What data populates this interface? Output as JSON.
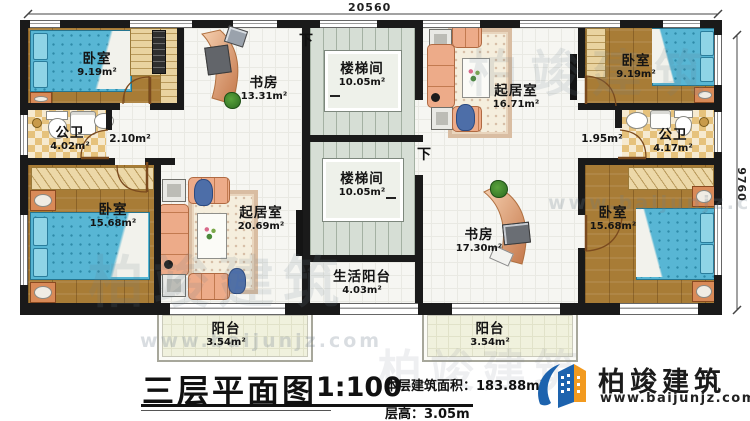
{
  "plan": {
    "title": "三层平面图",
    "scale": "1:100",
    "area_label": "本层建筑面积：",
    "area_value": "183.88m²",
    "floor_height_label": "层高：",
    "floor_height_value": "3.05m"
  },
  "dimensions": {
    "top": "20560",
    "right": "9760"
  },
  "labels": {
    "down": "下"
  },
  "rooms": {
    "bedroom_tl": {
      "name": "卧室",
      "area": "9.19m²"
    },
    "study_top": {
      "name": "书房",
      "area": "13.31m²"
    },
    "stair_top": {
      "name": "楼梯间",
      "area": "10.05m²"
    },
    "living_top": {
      "name": "起居室",
      "area": "16.71m²"
    },
    "bedroom_tr": {
      "name": "卧室",
      "area": "9.19m²"
    },
    "bath_left": {
      "name": "公卫",
      "area": "4.02m²"
    },
    "hall_left": {
      "area": "2.10m²"
    },
    "hall_right": {
      "area": "1.95m²"
    },
    "bath_right": {
      "name": "公卫",
      "area": "4.17m²"
    },
    "bedroom_bl": {
      "name": "卧室",
      "area": "15.68m²"
    },
    "living_bottom": {
      "name": "起居室",
      "area": "20.69m²"
    },
    "stair_bottom": {
      "name": "楼梯间",
      "area": "10.05m²"
    },
    "study_bottom": {
      "name": "书房",
      "area": "17.30m²"
    },
    "service_balcony": {
      "name": "生活阳台",
      "area": "4.03m²"
    },
    "bedroom_br": {
      "name": "卧室",
      "area": "15.68m²"
    },
    "balcony_left": {
      "name": "阳台",
      "area": "3.54m²"
    },
    "balcony_right": {
      "name": "阳台",
      "area": "3.54m²"
    }
  },
  "brand": {
    "name": "柏竣建筑",
    "site": "www.baijunjz.com"
  },
  "watermark": {
    "name": "柏竣建筑",
    "site": "www.baijunjz.com"
  },
  "colors": {
    "wall": "#1a1a1a",
    "wood": "#a87c36",
    "bed": "#58b6d4",
    "brand_blue": "#1d63ae",
    "brand_orange": "#f29a1f"
  }
}
